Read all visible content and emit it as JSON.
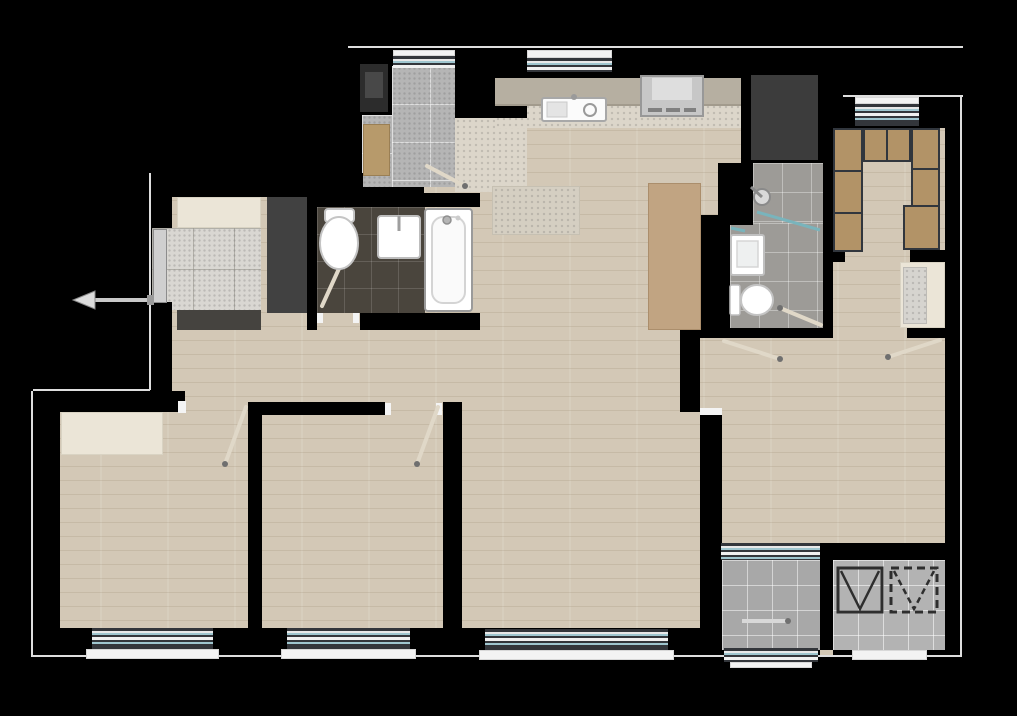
{
  "document": {
    "type": "residential apartment floor plan (top-down architectural rendering)",
    "canvas_px": {
      "width": 1017,
      "height": 716
    },
    "background": "#000000",
    "visible_text": "none"
  },
  "palette": {
    "wall": "#000000",
    "outline": "#dedede",
    "wood_floor": "#d3c8b6",
    "utility_tile": "#b5b5b5",
    "entry_stone": "#d9d7d2",
    "kitchen_stone": "#dcd6ca",
    "rug_stone": "#d5cfc2",
    "bath_dark_tile": "#4a453d",
    "bath_gray_tile": "#9d9b97",
    "balcony_tile": "#a8a8a8",
    "elevator_tile": "#b3b3b3",
    "cream_cabinet": "#ebe5d7",
    "dark_mat": "#45433f",
    "dark_wardrobe": "#414141",
    "storage_dark": "#3c3c3c",
    "counter": "#b6afa1",
    "wardrobe_wood": "#b29367",
    "bench_wood": "#b79a6b",
    "table_wood": "#c1a482",
    "fixture_white": "#ffffff",
    "window_glass": "#9fc6cf",
    "window_frame": "#33363b",
    "door_leaf": "#e0d8c8",
    "glass_screen": "#79b4bc",
    "appliance_dark": "#2c2c2c",
    "shaft_line": "#2e2e2e"
  },
  "rooms": [
    {
      "id": "utility-room",
      "floor": "gray ceramic tile",
      "fixtures": [
        "washing-machine",
        "wood-bench",
        "window",
        "door"
      ]
    },
    {
      "id": "kitchen",
      "floor": "stone tile strip",
      "fixtures": [
        "counter",
        "sink",
        "cooktop-hood",
        "window"
      ]
    },
    {
      "id": "living-dining-area",
      "floor": "wood plank",
      "fixtures": [
        "dining-table",
        "stone-rug"
      ]
    },
    {
      "id": "storage-closet",
      "floor": "dark cabinet footprint",
      "fixtures": []
    },
    {
      "id": "bathroom-main",
      "floor": "dark brown tile",
      "fixtures": [
        "toilet",
        "sink",
        "bathtub",
        "door"
      ]
    },
    {
      "id": "bathroom-second",
      "floor": "gray tile",
      "fixtures": [
        "shower-head",
        "glass-screen",
        "sink",
        "toilet",
        "door"
      ]
    },
    {
      "id": "walk-in-closet",
      "floor": "wood plank",
      "fixtures": [
        "wardrobe-blocks",
        "window"
      ]
    },
    {
      "id": "hallway-east",
      "floor": "wood plank",
      "fixtures": [
        "bay-window-niche",
        "doors"
      ]
    },
    {
      "id": "entry-foyer",
      "floor": "stone tile",
      "fixtures": [
        "shoe-cabinet",
        "dark-wardrobe",
        "entrance-door",
        "entrance-arrow",
        "door-mat"
      ]
    },
    {
      "id": "bedroom-1",
      "floor": "wood plank",
      "fixtures": [
        "cream-closet",
        "window",
        "door"
      ]
    },
    {
      "id": "bedroom-2",
      "floor": "wood plank",
      "fixtures": [
        "window",
        "door"
      ]
    },
    {
      "id": "living-room",
      "floor": "wood plank",
      "fixtures": [
        "window",
        "balcony-access"
      ]
    },
    {
      "id": "balcony",
      "floor": "gray tile",
      "fixtures": [
        "sliding-windows",
        "threshold"
      ]
    },
    {
      "id": "elevator-shaft-room",
      "floor": "gray tile",
      "fixtures": [
        "shaft-symbol-solid",
        "shaft-symbol-dashed"
      ]
    }
  ],
  "symbols": {
    "entrance_arrow": "arrow pointing left (out of unit) at entry door",
    "door_leaf_count": 7,
    "window_count": 9,
    "shaft_solid": "square outline with V diagonals (elevator/duct)",
    "shaft_dashed": "dashed square outline with dashed V (shaft void)"
  }
}
